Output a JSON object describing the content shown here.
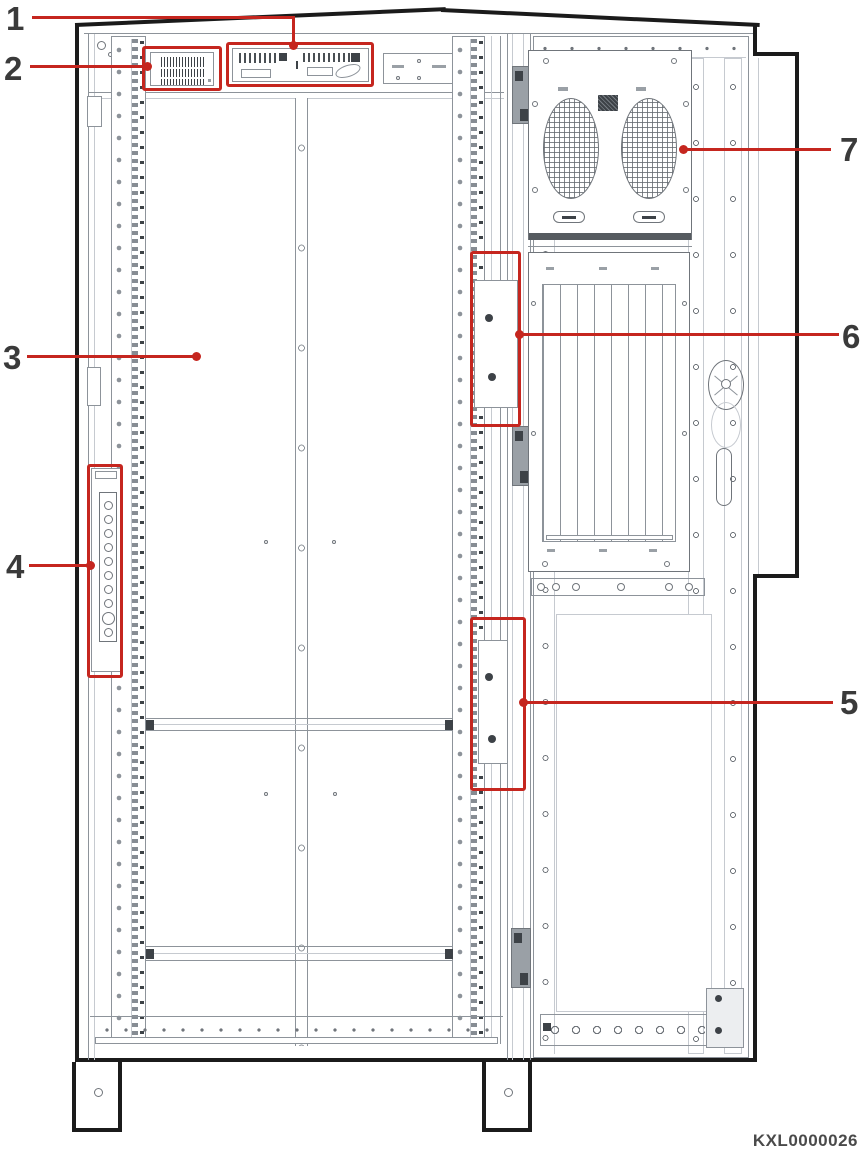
{
  "figure_code": "KXL0000026",
  "colors": {
    "red": "#c5261f",
    "ink": "#1b1b1b",
    "ln": "#8d939a",
    "txt": "#3a3a3a"
  },
  "callouts": [
    {
      "number": "1",
      "target": "warning-label-strip"
    },
    {
      "number": "2",
      "target": "barcode-label"
    },
    {
      "number": "3",
      "target": "main-compartment"
    },
    {
      "number": "4",
      "target": "cable-entry-strip"
    },
    {
      "number": "5",
      "target": "lower-hinge-cover"
    },
    {
      "number": "6",
      "target": "upper-hinge-cover"
    },
    {
      "number": "7",
      "target": "fan-panel"
    }
  ]
}
